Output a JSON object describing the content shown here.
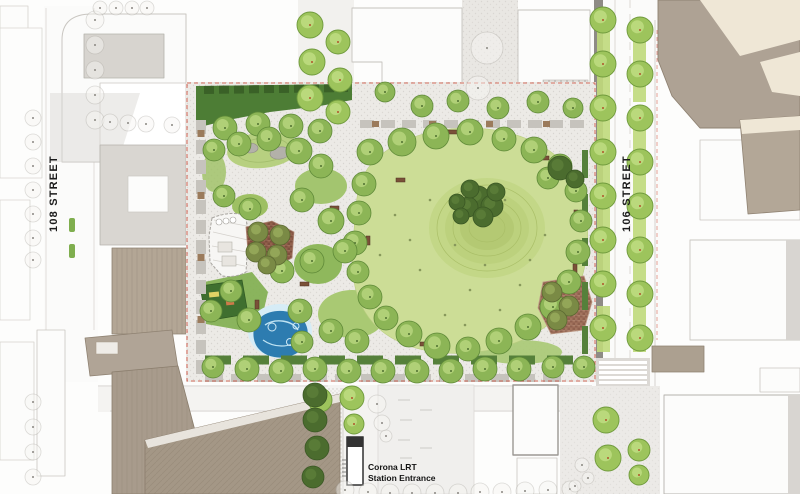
{
  "meta": {
    "plan_type": "landscape-architecture-site-plan",
    "subject": "urban park block between 108 Street and 106 Street with Corona LRT station entrance"
  },
  "labels": {
    "street_west": "108 STREET",
    "street_east": "106 STREET",
    "station_line1": "Corona LRT",
    "station_line2": "Station Entrance"
  },
  "colors": {
    "great_lawn": "#ccdd96",
    "north_lawn": "#4d7d35",
    "canopy_tree": "#8cb556",
    "street_tree": "#9dc45c",
    "evergreen_tree": "#4b6c2e",
    "water_feature": "#2d7cb0",
    "water_edge": "#d6ecf6",
    "plaza_paving_west": "#93604c",
    "plaza_paving_southeast": "#a3745e",
    "park_paving": "#eceae6",
    "context_building_taupe": "#aea294",
    "context_building_roof": "#efe7d6",
    "lrt_track": "#8e8b85",
    "property_line": "#cc4433",
    "label_text": "#1b1b1b"
  },
  "features": [
    {
      "name": "great-lawn"
    },
    {
      "name": "lawn-mound-with-evergreen-cluster"
    },
    {
      "name": "north-lawn"
    },
    {
      "name": "rock-hill"
    },
    {
      "name": "pavilion"
    },
    {
      "name": "west-plaza"
    },
    {
      "name": "southeast-plaza"
    },
    {
      "name": "playground"
    },
    {
      "name": "splash-pad"
    },
    {
      "name": "west-promenade"
    },
    {
      "name": "south-promenade"
    },
    {
      "name": "lrt-track"
    },
    {
      "name": "crosswalk"
    },
    {
      "name": "lrt-station-entrance"
    }
  ],
  "tree_groups": [
    {
      "name": "context-outline-trees",
      "fill": "#f7f6f3",
      "opacity": 0.45,
      "stroke": "#b2afa9",
      "stroke_width": 0.8,
      "dot": true,
      "dot_color": "#8a8781",
      "r": 9,
      "points": [
        [
          95,
          20,
          9
        ],
        [
          95,
          45,
          9
        ],
        [
          95,
          70,
          9
        ],
        [
          95,
          95,
          9
        ],
        [
          95,
          120,
          9
        ],
        [
          33,
          118,
          8
        ],
        [
          33,
          142,
          8
        ],
        [
          33,
          166,
          8
        ],
        [
          33,
          190,
          8
        ],
        [
          33,
          214,
          8
        ],
        [
          33,
          238,
          8
        ],
        [
          33,
          260,
          8
        ],
        [
          33,
          402,
          8
        ],
        [
          33,
          427,
          8
        ],
        [
          33,
          452,
          8
        ],
        [
          33,
          477,
          8
        ],
        [
          100,
          8,
          7
        ],
        [
          116,
          8,
          7
        ],
        [
          132,
          8,
          7
        ],
        [
          147,
          8,
          7
        ],
        [
          110,
          122,
          8
        ],
        [
          128,
          123,
          8
        ],
        [
          146,
          124,
          8
        ],
        [
          172,
          125,
          8
        ],
        [
          487,
          48,
          16
        ],
        [
          478,
          88,
          12
        ],
        [
          377,
          404,
          9
        ],
        [
          382,
          423,
          8
        ],
        [
          386,
          436,
          6
        ],
        [
          345,
          490,
          9
        ],
        [
          368,
          492,
          9
        ],
        [
          390,
          493,
          9
        ],
        [
          412,
          493,
          9
        ],
        [
          435,
          493,
          9
        ],
        [
          458,
          493,
          9
        ],
        [
          480,
          492,
          9
        ],
        [
          502,
          492,
          9
        ],
        [
          525,
          491,
          9
        ],
        [
          548,
          490,
          9
        ],
        [
          570,
          489,
          8
        ],
        [
          582,
          465,
          7
        ],
        [
          588,
          478,
          6
        ],
        [
          575,
          486,
          6
        ]
      ]
    },
    {
      "name": "street-boulevard-trees",
      "fill": "#9dc45c",
      "stroke": "#6f9a3c",
      "stroke_width": 0.9,
      "highlight": "#c2de84",
      "dot": true,
      "dot_color": "#b0542a",
      "r": 13,
      "points": [
        [
          603,
          20
        ],
        [
          603,
          64
        ],
        [
          603,
          108
        ],
        [
          603,
          152
        ],
        [
          603,
          196
        ],
        [
          603,
          240
        ],
        [
          603,
          284
        ],
        [
          603,
          328
        ],
        [
          606,
          420
        ],
        [
          608,
          458
        ],
        [
          640,
          30
        ],
        [
          640,
          74
        ],
        [
          640,
          118
        ],
        [
          640,
          162
        ],
        [
          640,
          206
        ],
        [
          640,
          250
        ],
        [
          640,
          294
        ],
        [
          640,
          338
        ],
        [
          639,
          450,
          11
        ],
        [
          639,
          475,
          10
        ],
        [
          310,
          25
        ],
        [
          312,
          62
        ],
        [
          310,
          98
        ],
        [
          338,
          42,
          12
        ],
        [
          340,
          80,
          12
        ],
        [
          338,
          112,
          12
        ],
        [
          320,
          400,
          12
        ],
        [
          352,
          398,
          12
        ],
        [
          354,
          424,
          10
        ]
      ]
    },
    {
      "name": "park-canopy-trees",
      "fill": "#8cb556",
      "stroke": "#5f8a38",
      "stroke_width": 0.8,
      "highlight": "#b9d77f",
      "dot": true,
      "dot_color": "#4f7030",
      "r": 12,
      "points": [
        [
          370,
          152,
          13
        ],
        [
          402,
          142,
          14
        ],
        [
          436,
          136,
          13
        ],
        [
          470,
          132,
          13
        ],
        [
          504,
          139,
          12
        ],
        [
          534,
          150,
          13
        ],
        [
          560,
          166,
          12
        ],
        [
          576,
          191,
          11
        ],
        [
          581,
          221,
          11
        ],
        [
          578,
          252,
          12
        ],
        [
          569,
          282,
          12
        ],
        [
          553,
          307,
          13
        ],
        [
          528,
          327,
          13
        ],
        [
          499,
          341,
          13
        ],
        [
          468,
          349,
          12
        ],
        [
          437,
          346,
          13
        ],
        [
          409,
          334,
          13
        ],
        [
          386,
          318,
          12
        ],
        [
          370,
          297,
          12
        ],
        [
          358,
          272,
          11
        ],
        [
          355,
          243,
          12
        ],
        [
          359,
          213,
          12
        ],
        [
          364,
          184,
          12
        ],
        [
          225,
          128,
          12
        ],
        [
          258,
          124,
          12
        ],
        [
          291,
          126,
          12
        ],
        [
          320,
          131,
          12
        ],
        [
          214,
          150,
          11
        ],
        [
          239,
          144,
          12
        ],
        [
          269,
          139,
          12
        ],
        [
          299,
          151,
          13
        ],
        [
          321,
          166,
          12
        ],
        [
          224,
          196,
          11
        ],
        [
          250,
          209,
          11
        ],
        [
          302,
          200,
          12
        ],
        [
          331,
          221,
          13
        ],
        [
          345,
          251,
          12
        ],
        [
          312,
          261,
          12
        ],
        [
          282,
          271,
          12
        ],
        [
          231,
          291,
          11
        ],
        [
          211,
          311,
          11
        ],
        [
          249,
          320,
          12
        ],
        [
          300,
          311,
          12
        ],
        [
          302,
          342,
          11
        ],
        [
          331,
          331,
          12
        ],
        [
          357,
          341,
          12
        ],
        [
          213,
          367,
          11
        ],
        [
          247,
          369,
          12
        ],
        [
          281,
          371,
          12
        ],
        [
          315,
          369,
          12
        ],
        [
          349,
          371,
          12
        ],
        [
          383,
          371,
          12
        ],
        [
          417,
          371,
          12
        ],
        [
          451,
          371,
          12
        ],
        [
          485,
          369,
          12
        ],
        [
          519,
          369,
          12
        ],
        [
          553,
          367,
          11
        ],
        [
          584,
          367,
          11
        ],
        [
          385,
          92,
          10
        ],
        [
          422,
          106,
          11
        ],
        [
          458,
          101,
          11
        ],
        [
          498,
          108,
          11
        ],
        [
          538,
          102,
          11
        ],
        [
          573,
          108,
          10
        ],
        [
          548,
          178,
          11
        ]
      ]
    },
    {
      "name": "evergreen-trees",
      "fill": "#4b6c2e",
      "stroke": "#3a5724",
      "stroke_width": 0.8,
      "highlight": "#5d7f3a",
      "r": 10,
      "points": [
        [
          478,
          198,
          12
        ],
        [
          492,
          206,
          11
        ],
        [
          468,
          207,
          10
        ],
        [
          483,
          217,
          10
        ],
        [
          496,
          192,
          9
        ],
        [
          470,
          189,
          9
        ],
        [
          457,
          202,
          8
        ],
        [
          461,
          216,
          8
        ],
        [
          560,
          168,
          12
        ],
        [
          575,
          179,
          9
        ],
        [
          315,
          395,
          12
        ],
        [
          315,
          420,
          12
        ],
        [
          317,
          448,
          12
        ],
        [
          313,
          477,
          11
        ]
      ]
    },
    {
      "name": "plaza-olive-trees",
      "fill": "#7a8a45",
      "stroke": "#5c6a32",
      "stroke_width": 0.8,
      "highlight": "#9aad5d",
      "r": 10,
      "points": [
        [
          258,
          232,
          10
        ],
        [
          280,
          235,
          10
        ],
        [
          256,
          252,
          10
        ],
        [
          277,
          255,
          10
        ],
        [
          267,
          265,
          9
        ],
        [
          552,
          292,
          10
        ],
        [
          569,
          306,
          10
        ],
        [
          557,
          320,
          10
        ]
      ]
    }
  ]
}
